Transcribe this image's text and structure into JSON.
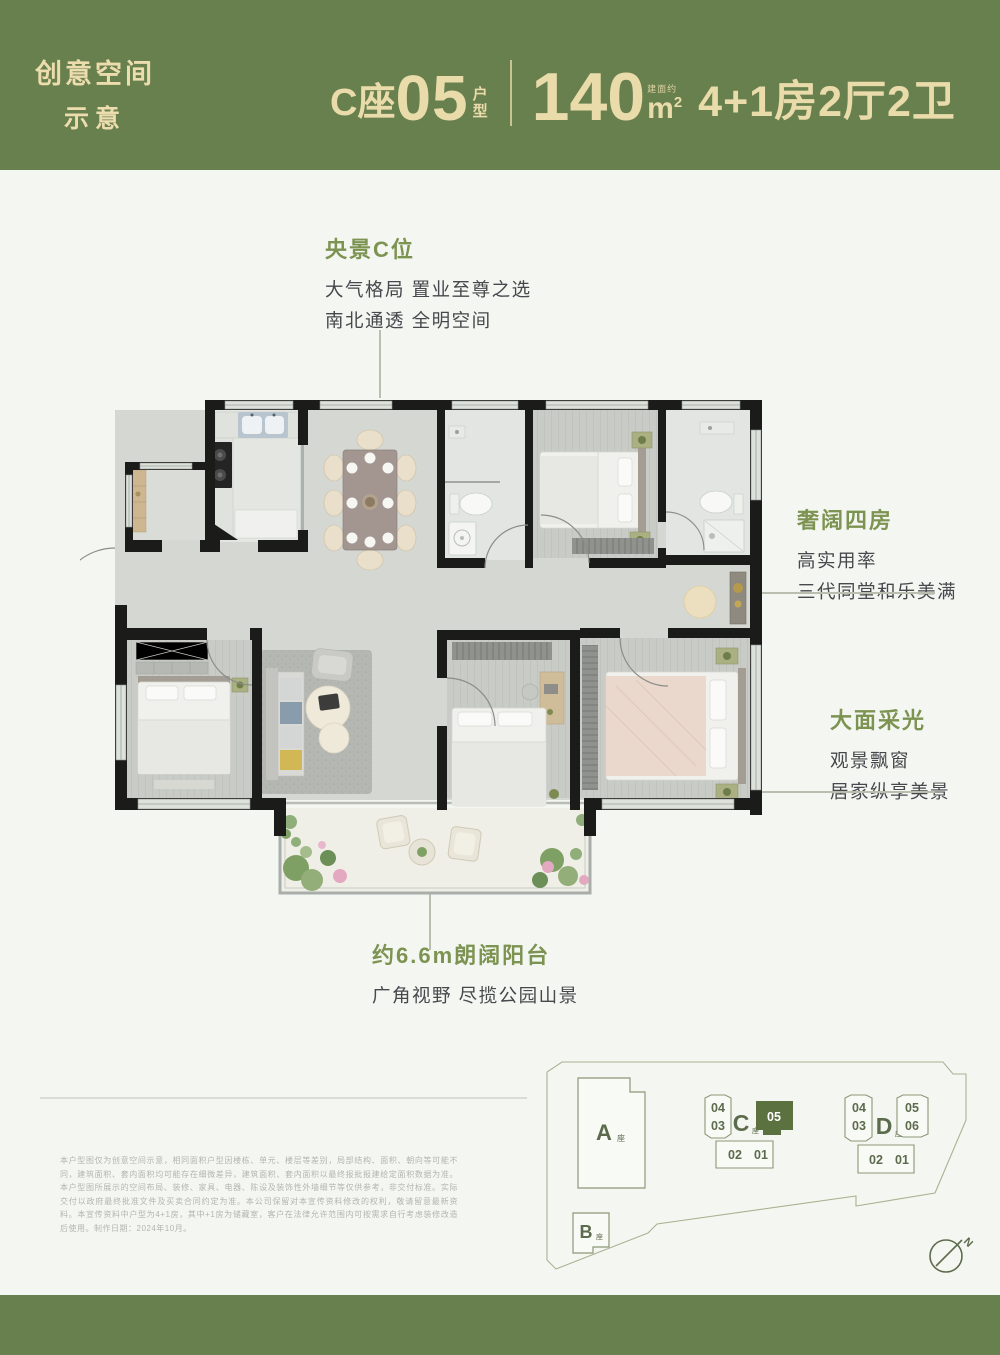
{
  "header": {
    "brand_line1": "创意空间",
    "brand_line2": "示意",
    "unit_prefix": "C座",
    "unit_number": "05",
    "unit_type_top": "户",
    "unit_type_bottom": "型",
    "area_value": "140",
    "area_note": "建面约",
    "area_unit_letter": "m",
    "area_unit_sup": "2",
    "spec": "4+1房2厅2卫"
  },
  "annotations": {
    "center": {
      "title": "央景C位",
      "line1": "大气格局 置业至尊之选",
      "line2": "南北通透 全明空间"
    },
    "rooms": {
      "title": "奢阔四房",
      "line1": "高实用率",
      "line2": "三代同堂和乐美满"
    },
    "light": {
      "title": "大面采光",
      "line1": "观景飘窗",
      "line2": "居家纵享美景"
    },
    "balcony": {
      "title": "约6.6m朗阔阳台",
      "line1": "广角视野 尽揽公园山景"
    }
  },
  "disclaimer": {
    "text": "本户型图仅为创意空间示意，相同面积户型因楼栋、单元、楼层等差别，局部结构、面积、朝向等可能不同，建筑面积、套内面积均可能存在细微差异，建筑面积、套内面积以最终报批报建给定面积数据为准。本户型图所展示的空间布局、装修、家具、电器、陈设及装饰性外墙细节等仅供参考，非交付标准。实际交付以政府最终批准文件及买卖合同约定为准。本公司保留对本宣传资料修改的权利，敬请留意最新资料。本宣传资料中户型为4+1房，其中+1房为储藏室，客户在法律允许范围内可按需求自行考虑装修改造后使用。制作日期：2024年10月。"
  },
  "site_plan": {
    "a_label": "A",
    "b_label": "B",
    "c_label": "C",
    "d_label": "D",
    "tower_suffix": "座",
    "c_u04": "04",
    "c_u03": "03",
    "c_u05": "05",
    "c_u02": "02",
    "c_u01": "01",
    "d_u04": "04",
    "d_u03": "03",
    "d_u05": "05",
    "d_u06": "06",
    "d_u02": "02",
    "d_u01": "01",
    "compass_n": "N",
    "highlight_color": "#5c7140"
  },
  "colors": {
    "band_green": "#68804d",
    "cream_text": "#eadbab",
    "annotation_green": "#7d9352",
    "body_text": "#45494d"
  }
}
